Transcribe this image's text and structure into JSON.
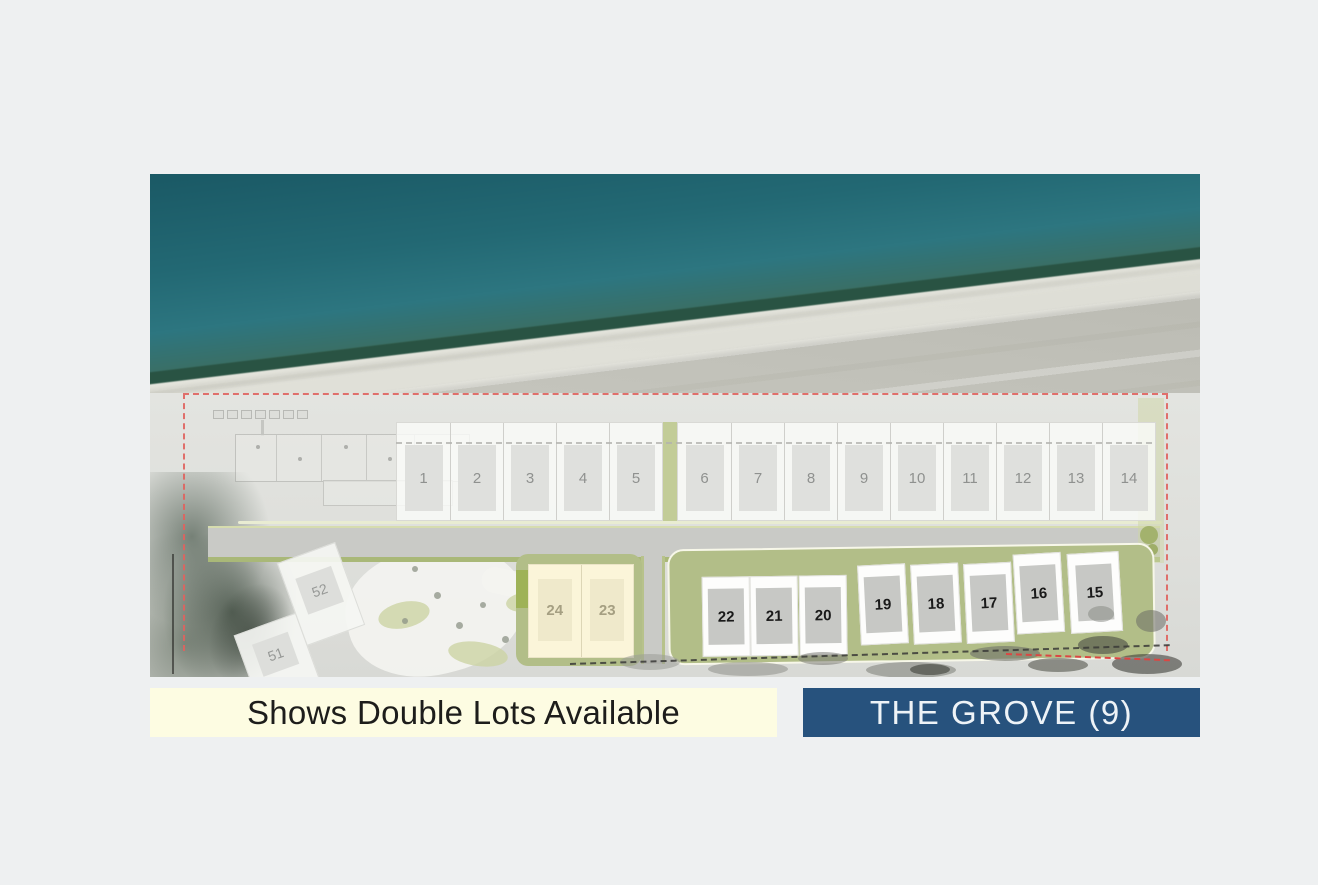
{
  "map": {
    "description": "Aerial beachfront site plan with numbered lots",
    "colors": {
      "ocean": "#1b5a66",
      "beach": "#c0c0b8",
      "boundary_red": "#e0635f",
      "landscape_green": "#b2be88",
      "double_lot_cream": "#fbf5d9",
      "lot_gray": "#dfe0dd"
    },
    "lots": {
      "beachfront_row": [
        "1",
        "2",
        "3",
        "4",
        "5",
        "6",
        "7",
        "8",
        "9",
        "10",
        "11",
        "12",
        "13",
        "14"
      ],
      "grove_row": [
        "22",
        "21",
        "20",
        "19",
        "18",
        "17",
        "16",
        "15"
      ],
      "double_lots": [
        "24",
        "23"
      ],
      "hillside_lots": [
        "52",
        "51"
      ]
    }
  },
  "legend": {
    "double_lots": {
      "label": "Shows Double Lots Available",
      "bg": "#fdfce2",
      "text_color": "#1d1d1b"
    },
    "grove": {
      "label": "THE GROVE (9)",
      "bg": "#27527d",
      "text_color": "#eef3f7",
      "count": "9"
    }
  }
}
